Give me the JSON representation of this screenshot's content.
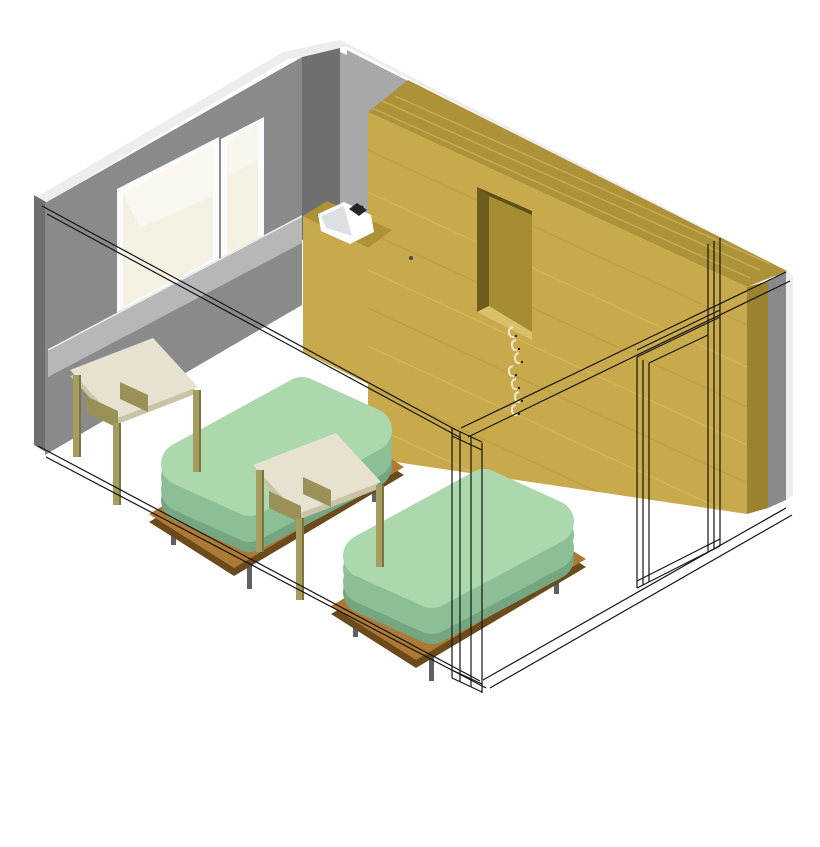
{
  "scene": {
    "title": "Axonometric 3D room view",
    "description": "Isometric cutaway rendering of a bedroom: two beds with green mattresses, two wooden tables, built-in wardrobe with open niche and coat hooks, corner sink, window wall, wireframe front walls with door frame",
    "bed_count": 2,
    "table_count": 2,
    "hook_count": 7,
    "window_pane_count": 2
  },
  "objects": {
    "left_wall": {
      "label": "left wall with window"
    },
    "back_wall": {
      "label": "back wall"
    },
    "right_wall": {
      "label": "right wall"
    },
    "front_walls": {
      "label": "front walls shown as transparent wireframe"
    },
    "window": {
      "label": "two-pane window"
    },
    "wardrobe": {
      "label": "built-in wardrobe with open niche"
    },
    "coat_hooks": {
      "label": "coat hooks on wardrobe"
    },
    "sink": {
      "label": "corner sink with faucet"
    },
    "door_frame": {
      "label": "door frame (wireframe)"
    },
    "bed": {
      "label": "bed with green mattress on wooden platform"
    },
    "table": {
      "label": "wooden table with cream top"
    }
  },
  "colors": {
    "background": "#FFFFFF",
    "wall_top_white": "#EDEDED",
    "wall_medium": "#8A8A8A",
    "wall_dark": "#6F6F6F",
    "wall_light": "#A8A8A8",
    "sill": "#B7B7B7",
    "frame_white": "#FBFBFB",
    "glass": "#F5F1E2",
    "glass_hi": "#FFFFFF",
    "cab_top": "#AE9238",
    "cab_front": "#C8AA4C",
    "cab_end": "#9A8230",
    "niche_back": "#A68C31",
    "niche_side": "#6F5D1F",
    "niche_top": "#5D4D17",
    "niche_bottom": "#D8C06C",
    "grain_dark": "#B3953C",
    "grain_light": "#DCC365",
    "knob": "#4A4A4A",
    "hook": "#F0E7CC",
    "basin_white": "#FFFFFF",
    "basin_shade": "#C7CBCF",
    "faucet": "#252525",
    "mattress_top": "#ACD8AD",
    "mattress_side": "#8DBF97",
    "mattress_dark": "#76A681",
    "platform_top": "#AD7A35",
    "platform_dark": "#6B4A1C",
    "leg_gray": "#5E6164",
    "table_top": "#E6E2CF",
    "table_edge": "#C9C3A8",
    "table_leg": "#A59C60",
    "table_leg_dark": "#7C7440",
    "apron": "#9A9158",
    "line": "#141414"
  }
}
